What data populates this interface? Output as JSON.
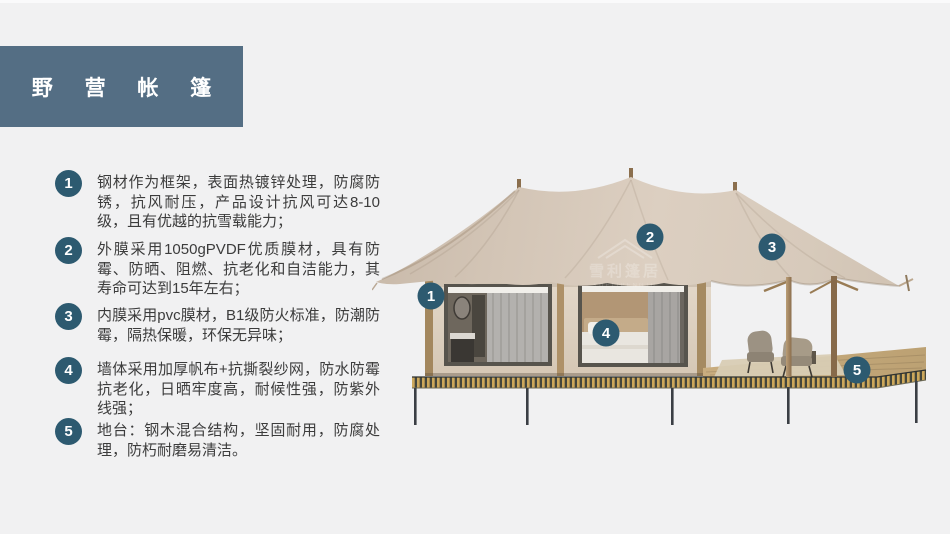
{
  "header": {
    "title": "野 营 帐 篷"
  },
  "features": [
    {
      "num": "1",
      "text": "钢材作为框架，表面热镀锌处理，防腐防锈，抗风耐压，产品设计抗风可达8-10级，且有优越的抗雪载能力；"
    },
    {
      "num": "2",
      "text": "外膜采用1050gPVDF优质膜材，具有防霉、防晒、阻燃、抗老化和自洁能力，其寿命可达到15年左右；"
    },
    {
      "num": "3",
      "text": "内膜采用pvc膜材，B1级防火标准，防潮防霉，隔热保暖，环保无异味；"
    },
    {
      "num": "4",
      "text": "墙体采用加厚帆布+抗撕裂纱网，防水防霉抗老化，日晒牢度高，耐候性强，防紫外线强；"
    },
    {
      "num": "5",
      "text": "地台：钢木混合结构，坚固耐用，防腐处理，防朽耐磨易清洁。"
    }
  ],
  "illustration": {
    "callouts": [
      {
        "n": "1"
      },
      {
        "n": "2"
      },
      {
        "n": "3"
      },
      {
        "n": "4"
      },
      {
        "n": "5"
      }
    ],
    "watermark": {
      "cn": "雪利篷居",
      "en": "YUELIPENGJU"
    }
  },
  "colors": {
    "background": "#F1F1F2",
    "banner": "#546E84",
    "badge": "#2D5A70",
    "body_text": "#3C3C3C",
    "canopy": "#D7CABB",
    "wall": "#DED2C2",
    "deck_gold": "#CDA85B",
    "deck_dark": "#44463C"
  }
}
